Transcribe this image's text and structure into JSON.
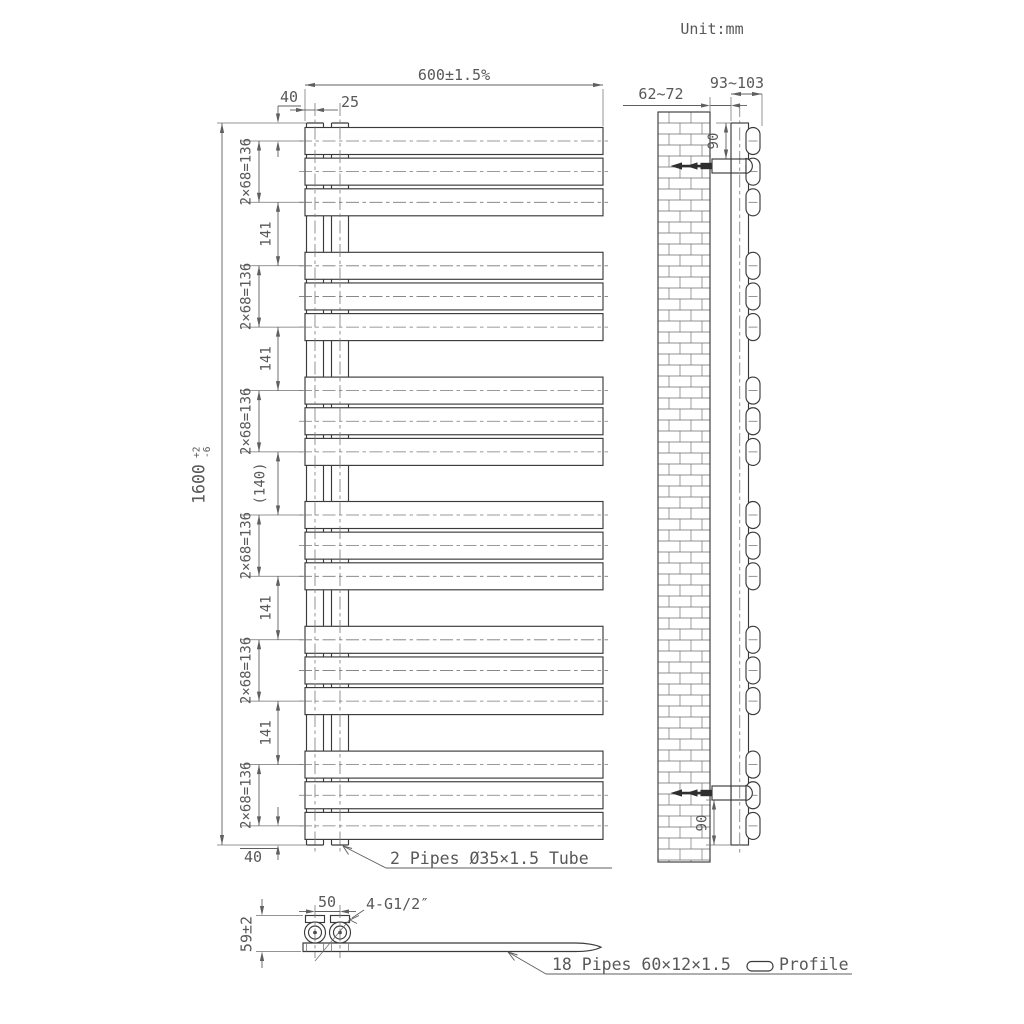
{
  "unit_label": "Unit:mm",
  "front_view": {
    "width_dim": "600±1.5%",
    "edge_to_tube_dim": "25",
    "top_end_dim": "40",
    "bottom_end_dim": "40",
    "overall_height_value": "1600",
    "overall_height_tol_plus": "+2",
    "overall_height_tol_minus": "-6",
    "group_span_dim": "2×68=136",
    "group_gap_dim": "141",
    "middle_gap_dim": "(140)",
    "pipe_groups": 6,
    "pipes_per_group": 3,
    "collector_note": "2 Pipes Ø35×1.5 Tube"
  },
  "side_view": {
    "wall_to_back_dim": "62~72",
    "wall_to_pipe_dim": "93~103",
    "top_bracket_dim": "90",
    "bottom_bracket_dim": "90"
  },
  "bottom_view": {
    "connection_spacing_dim": "50",
    "thread_label": "4-G1/2″",
    "depth_dim": "59±2",
    "pipes_note_prefix": "18 Pipes 60×12×1.5",
    "pipes_note_suffix": "Profile"
  }
}
